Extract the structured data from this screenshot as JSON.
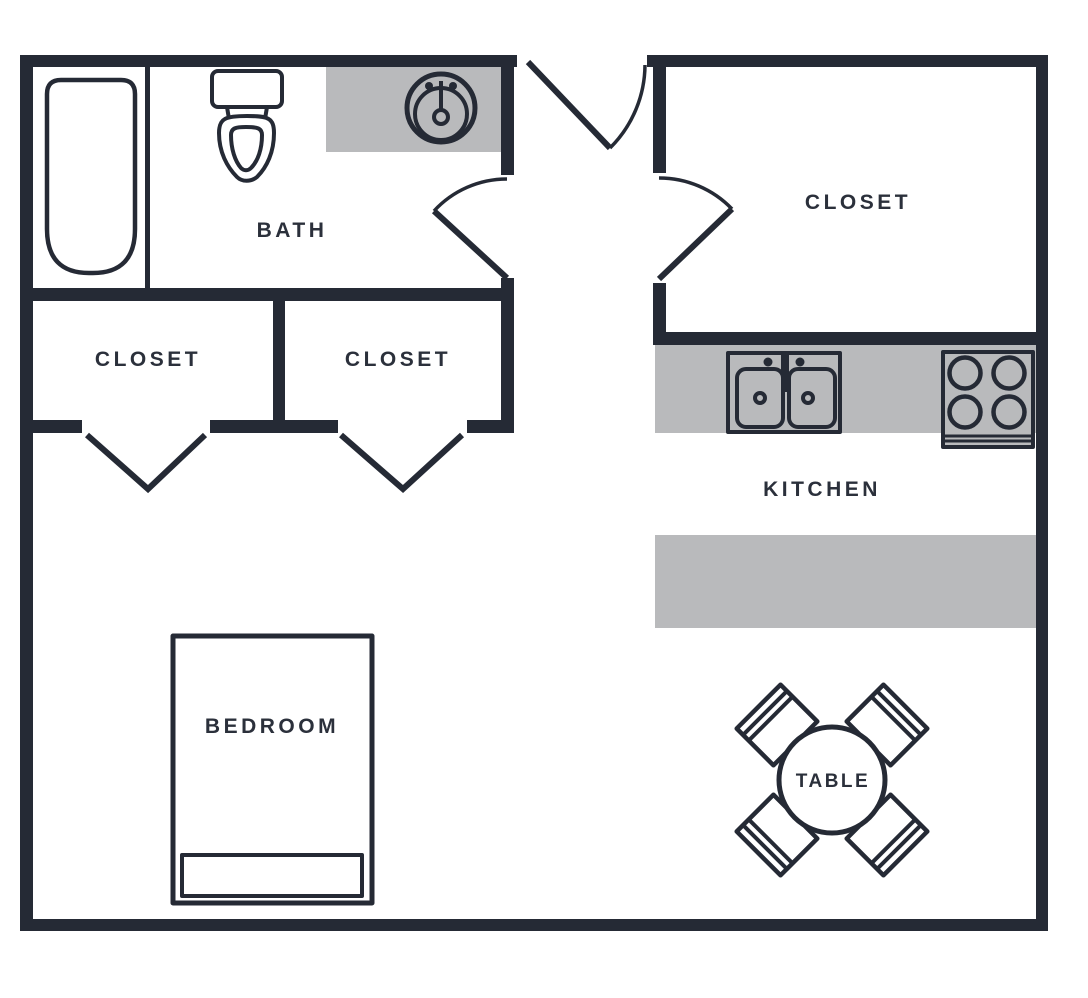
{
  "floor_plan": {
    "colors": {
      "background": "#ffffff",
      "wall": "#252a35",
      "counter": "#b9babc",
      "label": "#2b303b"
    },
    "rooms": {
      "bath": {
        "label": "BATH"
      },
      "closet_left": {
        "label": "CLOSET"
      },
      "closet_right": {
        "label": "CLOSET"
      },
      "closet_top_right": {
        "label": "CLOSET"
      },
      "kitchen": {
        "label": "KITCHEN"
      },
      "bedroom": {
        "label": "BEDROOM"
      },
      "dining_table": {
        "label": "TABLE"
      }
    },
    "fixtures": [
      "bathtub-icon",
      "toilet-icon",
      "bathroom-sink-icon",
      "double-kitchen-sink-icon",
      "stove-icon",
      "bed-icon",
      "pillow-icon",
      "round-table-icon",
      "chair-icon",
      "door-swing-icon",
      "folding-closet-door-icon"
    ]
  }
}
